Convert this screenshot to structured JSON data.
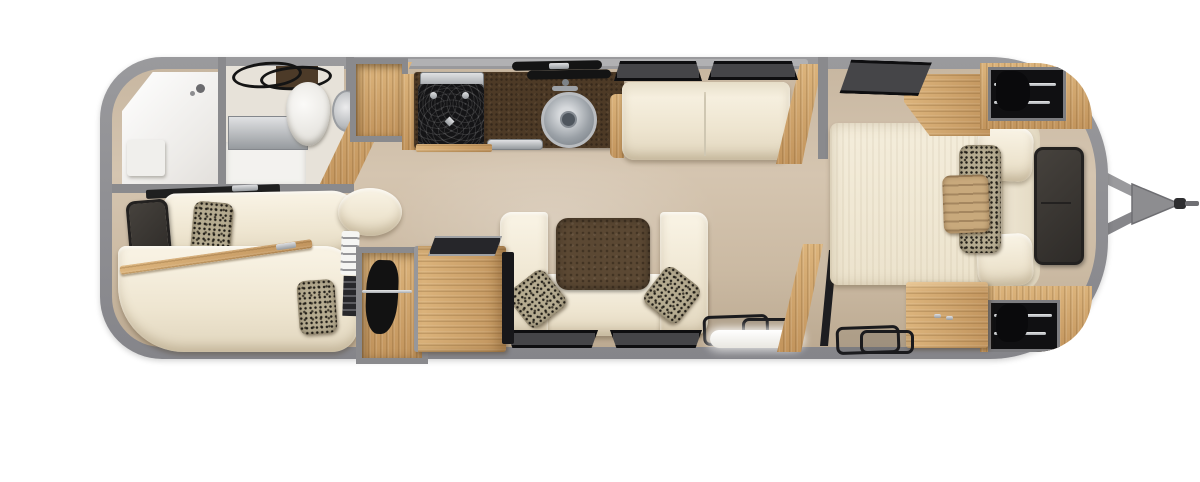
{
  "document": {
    "title": "Travel trailer floor plan — top-down rendering",
    "view": "overhead cutaway, hitch at right (front), rounded rear cap at left"
  },
  "palette": {
    "shell_gray": "#8e8e91",
    "floor_beige": "#cdbca6",
    "wood_oak": "#cda46e",
    "upholstery_cream": "#f1ead9",
    "counter_brown": "#4d3a26",
    "table_brown": "#5b4833",
    "appliance_black": "#161618",
    "stainless_steel": "#b9bcc0",
    "window_gray": "#454548",
    "accent_pillow_tan": "#c8a97c",
    "pillow_speckle": "#b5ab90"
  },
  "areas": {
    "exterior": {
      "label": "trailer shell",
      "items": {
        "shell": "aluminum shell wall outline",
        "hitch": "front tow hitch A-frame with coupler"
      }
    },
    "bathroom": {
      "label": "rear bathroom",
      "items": {
        "shower": "corner shower stall",
        "shower_seat": "shower shelf seat",
        "vanity": "vanity counter",
        "mirror": "vanity mirror strip",
        "towel_bars": "towel bars",
        "toilet": "toilet",
        "basin": "round wash basin",
        "closet": "open storage cubby",
        "partition": "angled wood partition"
      }
    },
    "rear_lounge": {
      "label": "rear lounge",
      "items": {
        "tv": "wall-mounted TV",
        "shelf": "rear shelf ledge",
        "chaise_top": "lounge chaise (window side)",
        "chaise_bottom": "curved lounge sofa",
        "wood_trim": "wood backrest trim",
        "pillow_1": "accent pillow",
        "pillow_2": "accent pillow"
      }
    },
    "kitchen": {
      "label": "galley kitchen",
      "items": {
        "counter": "dark stone countertop",
        "range": "two-burner gas range",
        "range_lid": "stainless range cover",
        "sink": "round stainless sink",
        "faucet": "faucet",
        "vents": "window / vent slats",
        "oven_handle": "oven drawer handle",
        "wood_edge": "wood cabinet edge"
      }
    },
    "living": {
      "label": "living area",
      "items": {
        "sofa": "two-seat sofa",
        "sofa_arm": "wood armrest",
        "end_panel": "wood end panel",
        "window_1": "window",
        "window_2": "window"
      }
    },
    "dinette": {
      "label": "U-shaped dinette",
      "items": {
        "bench": "U-shaped bench seating",
        "table": "walnut dinette table",
        "pillow_left": "accent pillow",
        "pillow_right": "accent pillow",
        "window_1": "window",
        "window_2": "window"
      }
    },
    "storage": {
      "label": "mid-ship storage",
      "items": {
        "towel_rack": "folded linen shelf",
        "vent_slats": "louvered vent",
        "closet": "hanging wardrobe",
        "cabinet": "wood cabinet",
        "cabinet_top": "dark counter tray",
        "side_panel": "appliance panel"
      }
    },
    "entry": {
      "label": "entry door area",
      "items": {
        "floor_mats": "floor mats",
        "step": "entry step",
        "partition": "wood privacy partition",
        "panel": "dark divider panel"
      }
    },
    "bedroom": {
      "label": "front bedroom",
      "items": {
        "bed": "queen bed",
        "headboard": "upholstered headboard",
        "pillow_cream_top": "sleeping pillow",
        "pillow_cream_bottom": "sleeping pillow",
        "pillow_speckle": "patterned lumbar pillow",
        "pillow_tan": "tan accent pillow",
        "tv": "bedroom TV",
        "nightstand": "wood nightstand",
        "window": "window over bed",
        "wardrobe_top": "front curved wardrobe (hanging clothes)",
        "wardrobe_bottom": "front curved wardrobe (hanging clothes)",
        "dresser": "foot-of-bed dresser",
        "floor_mats": "floor mats"
      }
    }
  }
}
